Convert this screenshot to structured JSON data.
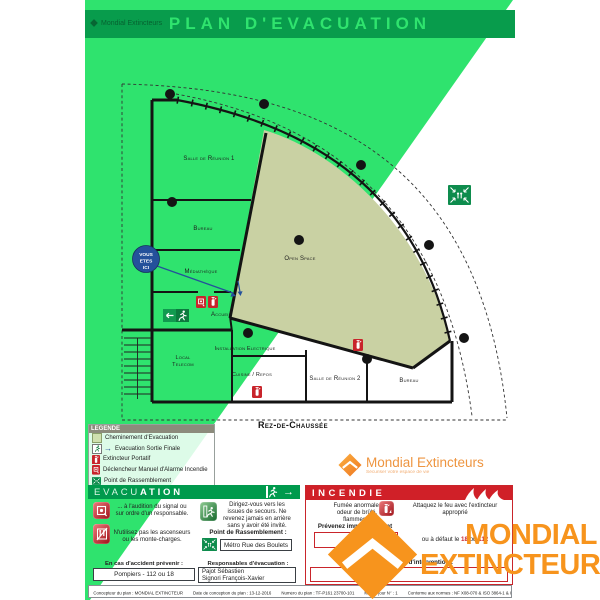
{
  "title": "PLAN D'EVACUATION",
  "brand": {
    "name": "Mondial Extincteurs",
    "tagline": "Sécuriser votre espace de vie",
    "watermark_line1": "MONDIAL",
    "watermark_line2": "EXTINCTEUR"
  },
  "icons": {
    "arrow_right": "→"
  },
  "plan": {
    "floor_label": "Rez-de-Chaussée",
    "you_are_here": {
      "line1": "VOUS",
      "line2": "ETES",
      "line3": "ICI"
    },
    "rooms": {
      "salle_reunion_1": "Salle de Réunion 1",
      "bureau_1": "Bureau",
      "mediatheque": "Médiathèque",
      "accueil": "Accueil",
      "open_space": "Open Space",
      "installation_electrique": "Installation Electrique",
      "local_telecom_1": "Local",
      "local_telecom_2": "Telecom",
      "cuisine_repos": "Cuisine / Repos",
      "salle_reunion_2": "Salle de Réunion 2",
      "bureau_2": "Bureau"
    }
  },
  "legend": {
    "title": "LEGENDE",
    "items": [
      "Cheminement d'Evacuation",
      "Evacuation Sortie Finale",
      "Extincteur Portatif",
      "Déclencheur Manuel d'Alarme Incendie",
      "Point de Rassemblement"
    ]
  },
  "evacuation_panel": {
    "title_part1": "EVACU",
    "title_part2": "ATION",
    "instruction_signal": "... à l'audition du signal ou sur ordre d'un responsable.",
    "instruction_elevator": "N'utilisez pas les ascenseurs ou les monte-charges.",
    "instruction_exits": "Dirigez-vous vers les issues de secours. Ne revenez jamais en arrière sans y avoir été invité.",
    "assembly_label": "Point de Rassemblement :",
    "assembly_value": "Métro Rue des Boulets",
    "accident_label": "En cas d'accident prévenir :",
    "accident_value": "Pompiers - 112 ou 18",
    "responsables_label": "Responsables d'évacuation :",
    "responsables_value_1": "Pajot Sébastien",
    "responsables_value_2": "Signori François-Xavier"
  },
  "incendie_panel": {
    "title": "INCENDIE",
    "alert_text": "Fumée anormale, odeur de brûlé, flammes ?",
    "notify_label": "Prévenez immédiatement",
    "notify_value": "18",
    "attack_text": "Attaquez le feu avec l'extincteur approprié",
    "fallback_prefix": "ou à défaut le ",
    "fallback_num1": "18",
    "fallback_or": " ou ",
    "fallback_num2": "112",
    "responsables_label": "Responsables d'intervention :"
  },
  "footer": {
    "concepteur": "Concepteur du plan : MONDIAL EXTINCTEUR",
    "date": "Date de conception du plan : 13-12-2016",
    "numero": "Numéro du plan : TF-P161 23700-101",
    "mise_a_jour": "Mise à jour N° : 1",
    "normes": "Conforme aux normes : NF X08-070 & ISO 3864-1 & ISO 3864-3"
  },
  "colors": {
    "green_bright": "#2FE36E",
    "green_dark": "#089C4C",
    "evac_green": "#009A4D",
    "incendie_red": "#D02028",
    "open_space_beige": "#C9D1A3",
    "you_are_here_blue": "#24519B",
    "watermark_orange": "#F7941D"
  }
}
